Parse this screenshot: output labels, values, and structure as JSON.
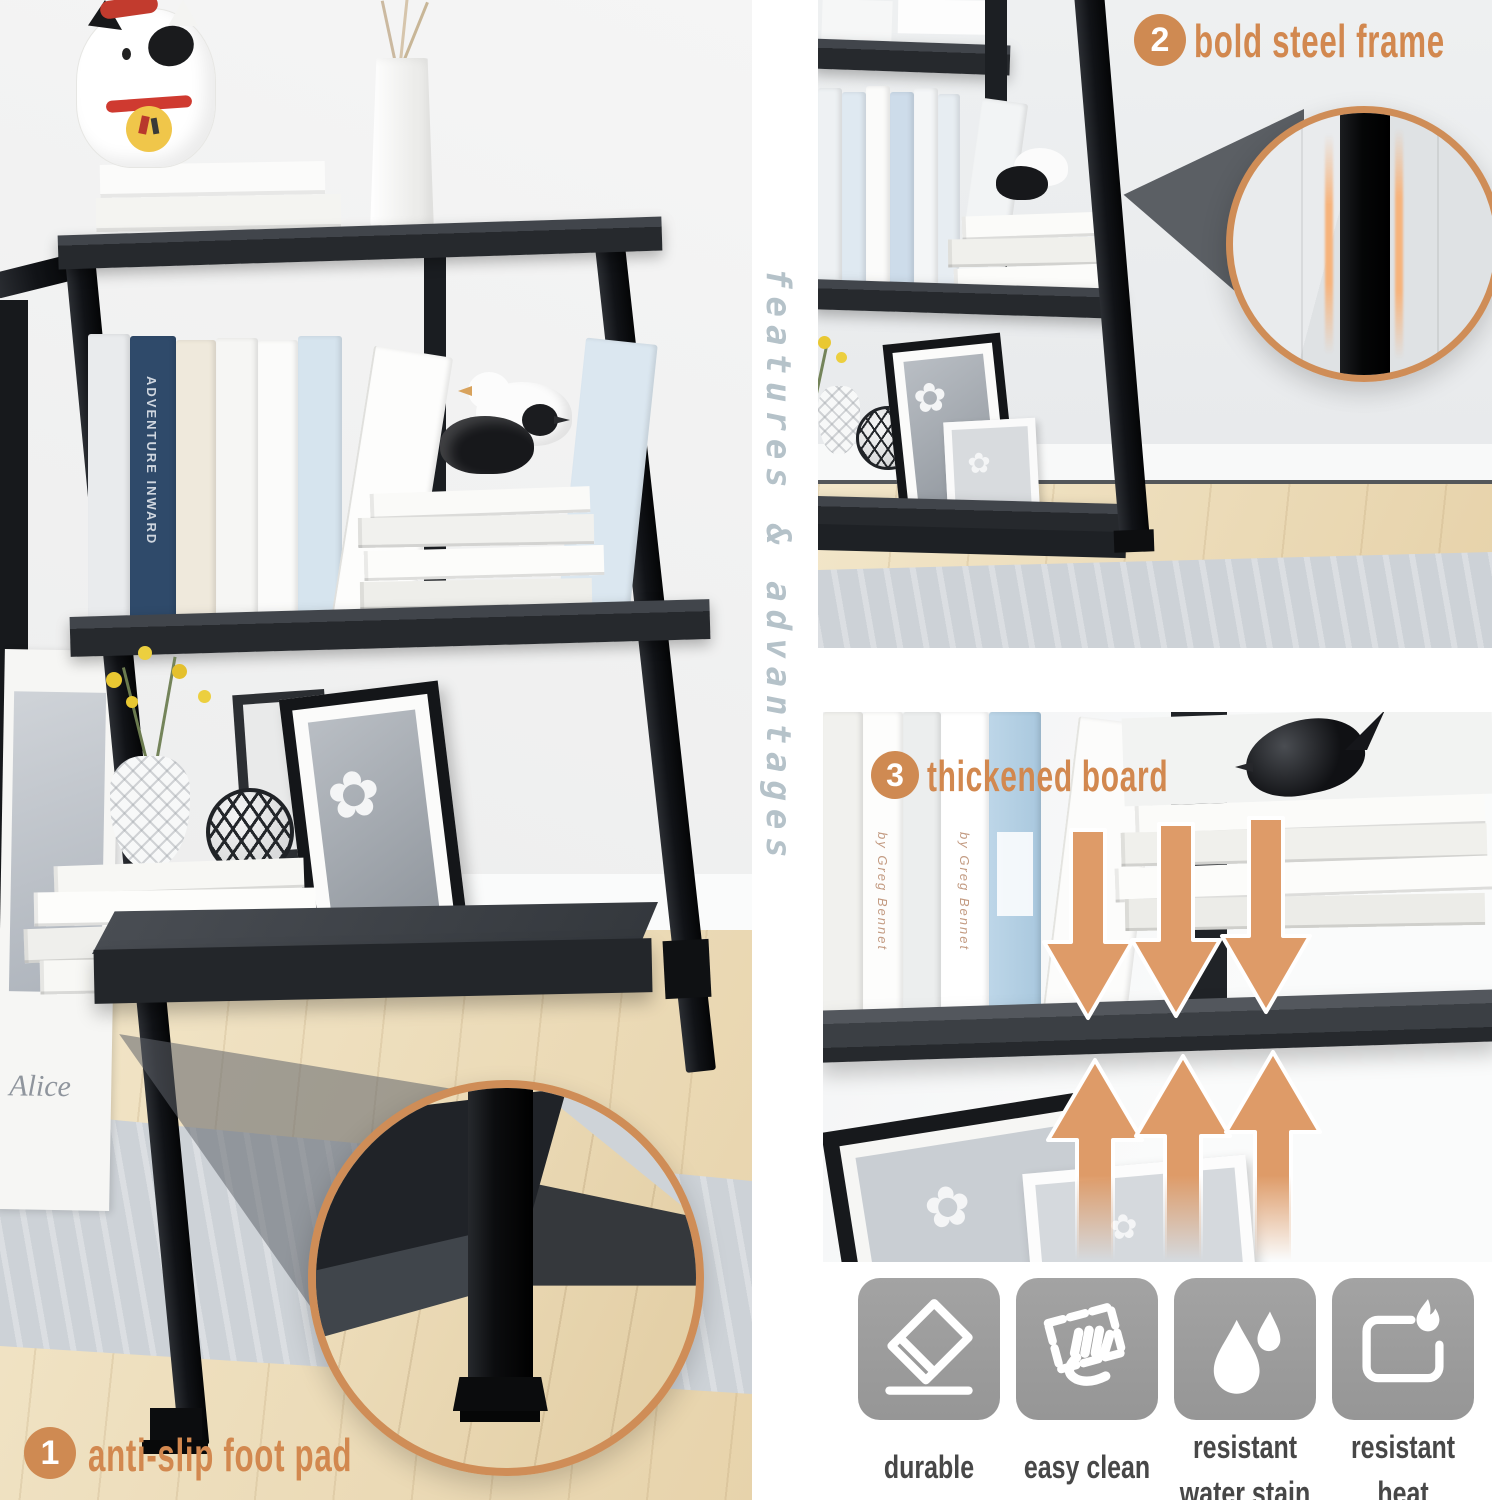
{
  "colors": {
    "accent_orange": "#cf8a52",
    "arrow_orange": "#de9b68",
    "vertical_text_color": "#b5c2c9",
    "tile_gray": "#9c9c9c",
    "caption_gray": "#474747"
  },
  "banner": {
    "vertical_text": "features & advantages"
  },
  "callouts": {
    "one": {
      "number": "1",
      "label": "anti-slip foot pad"
    },
    "two": {
      "number": "2",
      "label": "bold steel frame"
    },
    "three": {
      "number": "3",
      "label": "thickened board"
    }
  },
  "tiles": [
    {
      "icon": "eraser-icon",
      "lines": [
        "durable"
      ]
    },
    {
      "icon": "wipe-clean-icon",
      "lines": [
        "easy clean"
      ]
    },
    {
      "icon": "water-drops-icon",
      "lines": [
        "resistant",
        "water stain"
      ]
    },
    {
      "icon": "flame-icon",
      "lines": [
        "resistant",
        "heat"
      ]
    }
  ],
  "photo_details": {
    "book_spine_text": "ADVENTURE INWARD",
    "poster_text": "Alice",
    "spine_script_text": "by Greg Bennet",
    "flower_glyph": "✿"
  }
}
